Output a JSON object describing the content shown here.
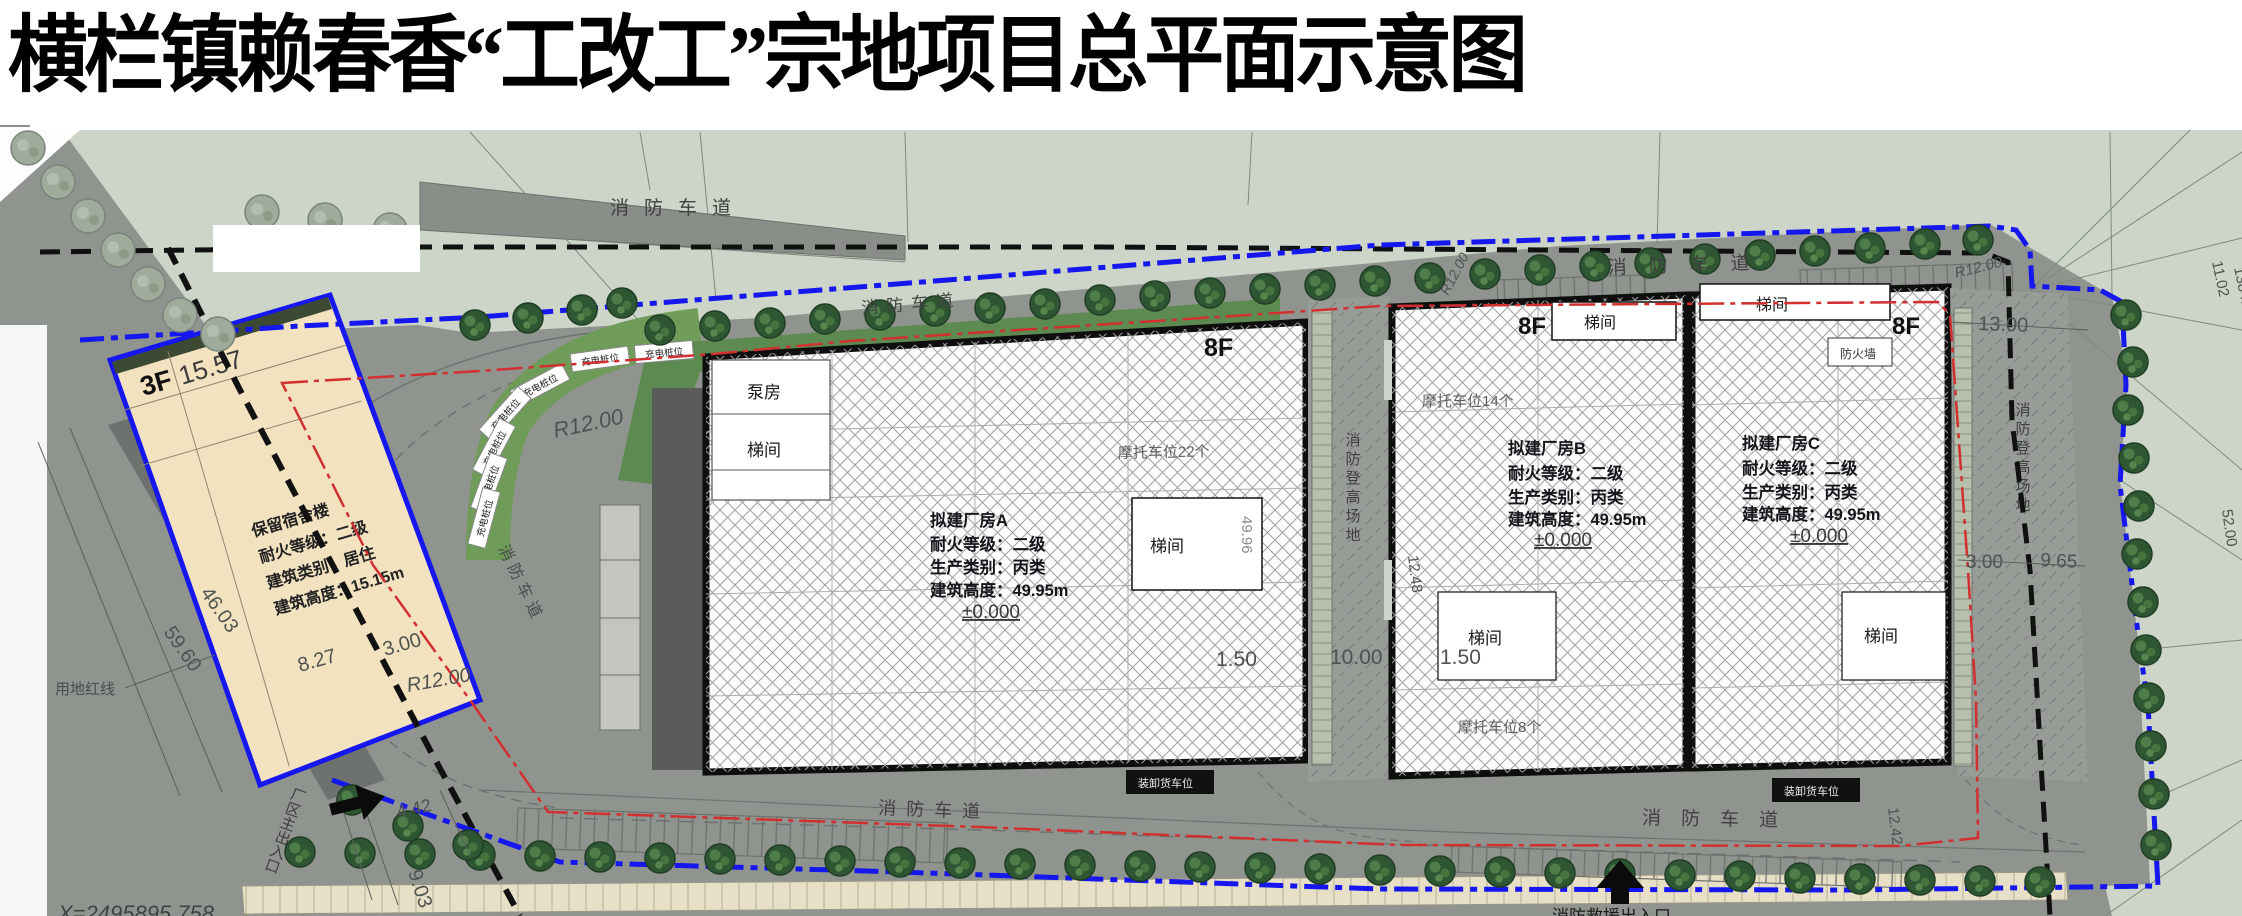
{
  "title": "横栏镇赖春香“工改工”宗地项目总平面示意图",
  "colors": {
    "boundary_blue": "#1616ee",
    "control_red": "#d23030",
    "parcel_black": "#111111",
    "dorm_fill": "#f2e2c0",
    "site_grey": "#90948f",
    "sage_green": "#ccd5c7",
    "tree_green": "#2e5632",
    "charging_green": "#6f9c58"
  },
  "plan": {
    "roads": {
      "fire_lane": "消防车道"
    },
    "site": {
      "red_line_label": "用地红线",
      "main_entrance": "厂区主出入口",
      "fire_rescue_entrance": "消防救援出入口",
      "fire_ladder_area": "消防登高场地",
      "charging_spot": "充电桩位",
      "coord_x": "X=2495895.758"
    },
    "buildings": {
      "dorm": {
        "floor": "3F",
        "roof_elev": "15.57",
        "name": "保留宿舍楼",
        "fire_rating": "耐火等级：二级",
        "category": "建筑类别：居住",
        "height": "建筑高度：15.15m"
      },
      "factory_a": {
        "floor": "8F",
        "name": "拟建厂房A",
        "fire_rating": "耐火等级：二级",
        "category": "生产类别：丙类",
        "height": "建筑高度：49.95m",
        "level": "±0.000",
        "pump_room": "泵房",
        "stair": "梯间",
        "stair_elev": "49.96",
        "moto": "摩托车位22个",
        "loading": "装卸货车位"
      },
      "factory_b": {
        "floor": "8F",
        "name": "拟建厂房B",
        "fire_rating": "耐火等级：二级",
        "category": "生产类别：丙类",
        "height": "建筑高度：49.95m",
        "level": "±0.000",
        "stair": "梯间",
        "moto_top": "摩托车位14个",
        "moto_bottom": "摩托车位8个"
      },
      "factory_c": {
        "floor": "8F",
        "name": "拟建厂房C",
        "fire_rating": "耐火等级：二级",
        "category": "生产类别：丙类",
        "height": "建筑高度：49.95m",
        "level": "±0.000",
        "stair": "梯间",
        "firewall": "防火墙",
        "loading": "装卸货车位"
      }
    },
    "dims": {
      "r12": "R12.00",
      "d46": "46.03",
      "d59": "59.60",
      "d9": "9.03",
      "d827": "8.27",
      "d3": "3.00",
      "d442": "4.42",
      "d150": "1.50",
      "d1000": "10.00",
      "d1248": "12.48",
      "d1300": "13.00",
      "d965": "9.65",
      "d1242": "12.42",
      "d1102": "11.02",
      "d138441": "1384.41",
      "d5200": "52.00"
    }
  }
}
